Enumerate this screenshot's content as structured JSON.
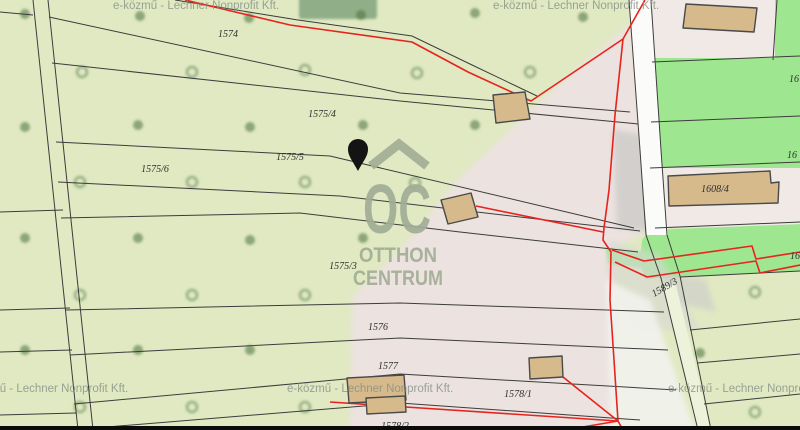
{
  "map": {
    "watermark_provider": "e-közmű - Lechner Nonprofit Kft.",
    "brand": {
      "initials": "OC",
      "line1": "OTTHON",
      "line2": "CENTRUM"
    },
    "parcel_labels": [
      {
        "text": "1574"
      },
      {
        "text": "1575/4"
      },
      {
        "text": "1575/5"
      },
      {
        "text": "1575/6"
      },
      {
        "text": "1575/3"
      },
      {
        "text": "1576"
      },
      {
        "text": "1577"
      },
      {
        "text": "1578/1"
      },
      {
        "text": "1578/2"
      },
      {
        "text": "1589/3"
      },
      {
        "text": "1608/4"
      },
      {
        "text": "16"
      },
      {
        "text": "16"
      },
      {
        "text": "16"
      }
    ],
    "colors": {
      "field_green": "#e0e9c2",
      "yard_green": "#9fe691",
      "surface_pink": "#ece2df",
      "beige_block": "#f0e9e5",
      "road_white": "#fbfbf9",
      "road_gray": "#c6c6c4",
      "building_tan": "#d6ba8b",
      "boundary_black": "#3c3c3c",
      "highlight_red": "#e8231d",
      "tree_green": "#4d7440",
      "structure_green": "#8cab84",
      "watermark_gray": "#a2ad96",
      "marker_black": "#141414",
      "bottom_bar_black": "#0b0b0b"
    }
  }
}
